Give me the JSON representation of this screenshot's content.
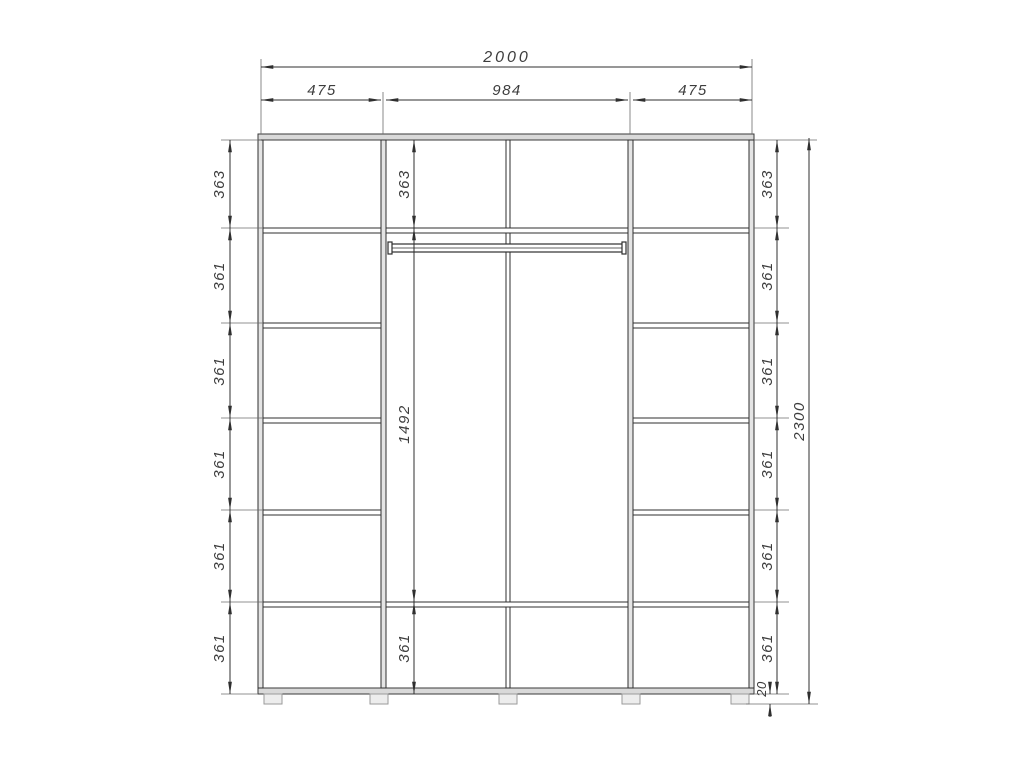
{
  "drawing": {
    "type": "wardrobe-front-elevation",
    "line_color": "#2f2f2f",
    "panel_fill": "#d9d9d9",
    "background": "#ffffff"
  },
  "dims": {
    "width_total": "2000",
    "height_total": "2300",
    "top": [
      "475",
      "984",
      "475"
    ],
    "left": [
      "363",
      "361",
      "361",
      "361",
      "361",
      "361"
    ],
    "middle": [
      "363",
      "1492",
      "361"
    ],
    "right": [
      "363",
      "361",
      "361",
      "361",
      "361",
      "361"
    ],
    "base": "20"
  }
}
